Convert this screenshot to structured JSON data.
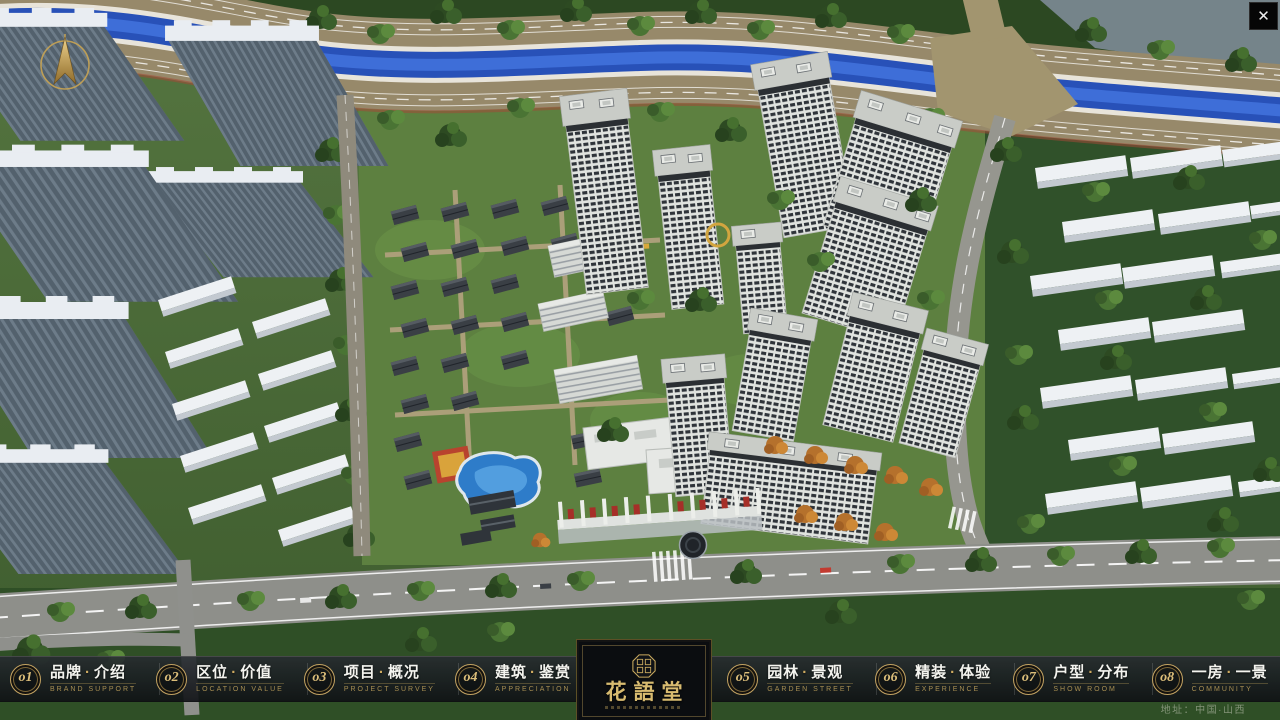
{
  "chrome": {
    "close_glyph": "✕"
  },
  "nav": {
    "separator": "·",
    "items": [
      {
        "id": "brand",
        "num": "o1",
        "zh_left": "品牌",
        "zh_right": "介绍",
        "en": "BRAND SUPPORT"
      },
      {
        "id": "location",
        "num": "o2",
        "zh_left": "区位",
        "zh_right": "价值",
        "en": "LOCATION VALUE"
      },
      {
        "id": "project",
        "num": "o3",
        "zh_left": "项目",
        "zh_right": "概况",
        "en": "PROJECT SURVEY"
      },
      {
        "id": "architecture",
        "num": "o4",
        "zh_left": "建筑",
        "zh_right": "鉴赏",
        "en": "APPRECIATION"
      },
      {
        "id": "garden",
        "num": "o5",
        "zh_left": "园林",
        "zh_right": "景观",
        "en": "GARDEN STREET"
      },
      {
        "id": "interior",
        "num": "o6",
        "zh_left": "精装",
        "zh_right": "体验",
        "en": "EXPERIENCE"
      },
      {
        "id": "units",
        "num": "o7",
        "zh_left": "户型",
        "zh_right": "分布",
        "en": "SHOW ROOM"
      },
      {
        "id": "views",
        "num": "o8",
        "zh_left": "一房",
        "zh_right": "一景",
        "en": "COMMUNITY"
      }
    ]
  },
  "logo": {
    "title": "花語堂"
  },
  "footer": {
    "address": "地址：中国·山西"
  },
  "colors": {
    "gold": "#c9a95e",
    "river": "#2851b8",
    "bar_bg": "#14171b"
  }
}
